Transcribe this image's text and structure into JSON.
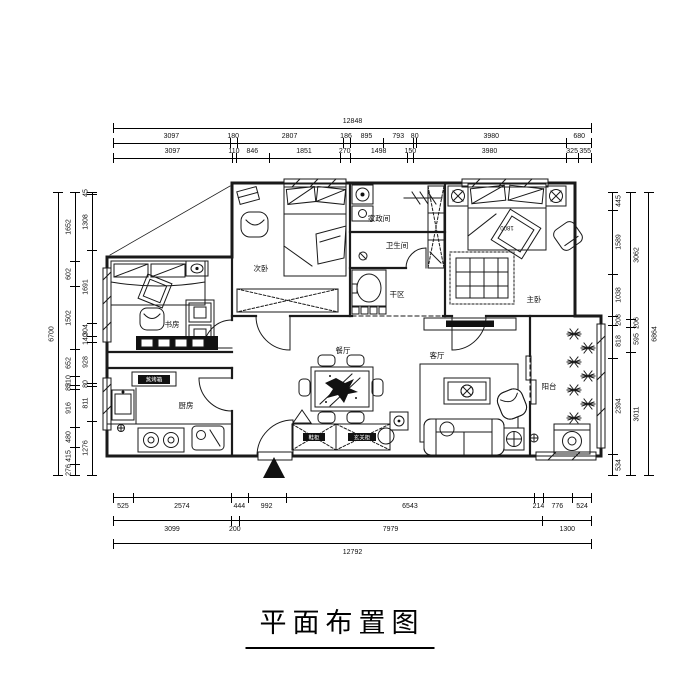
{
  "title": "平面布置图",
  "rooms": {
    "study": "书房",
    "second_bedroom": "次卧",
    "laundry": "家政间",
    "bathroom": "卫生间",
    "dry_area": "干区",
    "master_bedroom": "主卧",
    "kitchen": "厨房",
    "dining": "餐厅",
    "living": "客厅",
    "balcony": "阳台"
  },
  "labels": {
    "shoe_cabinet": "鞋柜",
    "entry_cabinet": "玄关柜",
    "steam_oven": "蒸烤箱",
    "bed_width": "1800"
  },
  "dimensions": {
    "top_rows": [
      [
        "12848"
      ],
      [
        "3097",
        "180",
        "2807",
        "186",
        "895",
        "793",
        "80",
        "3980",
        "680"
      ],
      [
        "3097",
        "110",
        "846",
        "1851",
        "270",
        "1498",
        "150",
        "3980",
        "325",
        "355"
      ]
    ],
    "bottom_rows": [
      [
        "525",
        "2574",
        "444",
        "992",
        "6543",
        "214",
        "776",
        "524"
      ],
      [
        "3099",
        "200",
        "7979",
        "1300"
      ],
      [
        "12792"
      ]
    ],
    "left_cols": [
      [
        "6700"
      ],
      [
        "1652",
        "602",
        "1502",
        "652",
        "210",
        "85",
        "916",
        "480",
        "415",
        "276"
      ],
      [
        "45",
        "1308",
        "1691",
        "304",
        "140",
        "928",
        "80",
        "811",
        "1276"
      ]
    ],
    "right_cols": [
      [
        "445",
        "1589",
        "1038",
        "208",
        "818",
        "2394",
        "534"
      ],
      [
        "3062",
        "206",
        "595",
        "3011"
      ],
      [
        "6864"
      ]
    ]
  }
}
